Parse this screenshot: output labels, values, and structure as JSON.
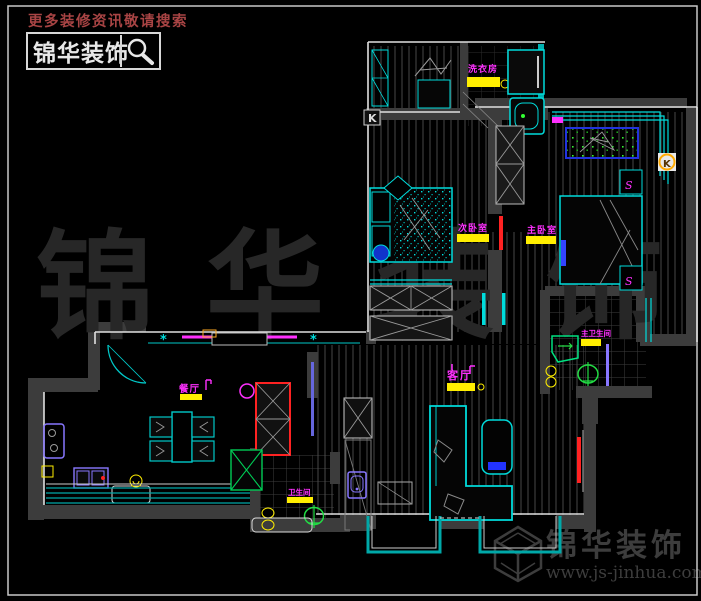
{
  "branding_top": {
    "tagline": "更多装修资讯敬请搜索",
    "logo_text": "锦华装饰"
  },
  "watermark": {
    "text": "锦华装饰"
  },
  "branding_bottom": {
    "company": "锦华装饰",
    "website": "www.js-jinhua.com"
  },
  "floor_plan": {
    "rooms": {
      "laundry": {
        "label": "洗衣房"
      },
      "bedroom2": {
        "label": "次卧室"
      },
      "master_bedroom": {
        "label": "主卧室"
      },
      "master_bath": {
        "label": "主卫生间"
      },
      "living": {
        "label": "客厅"
      },
      "dining": {
        "label": "餐厅"
      },
      "bath": {
        "label": "卫生间"
      }
    },
    "markers": {
      "k1": "K",
      "k2": "K",
      "s1": "S",
      "s2": "S",
      "asterisk1": "*",
      "asterisk2": "*"
    }
  },
  "colors": {
    "cyan": "#00dcdc",
    "teal": "#00a8a8",
    "magenta": "#ff30ff",
    "yellow": "#ffee00",
    "red": "#ff2222",
    "blue": "#2233ee",
    "green": "#22dd44",
    "purple": "#8877ff",
    "orange": "#ffaa22",
    "wall": "#3c3c3c",
    "watermark": "#282828",
    "tagline_red": "#a84444"
  }
}
